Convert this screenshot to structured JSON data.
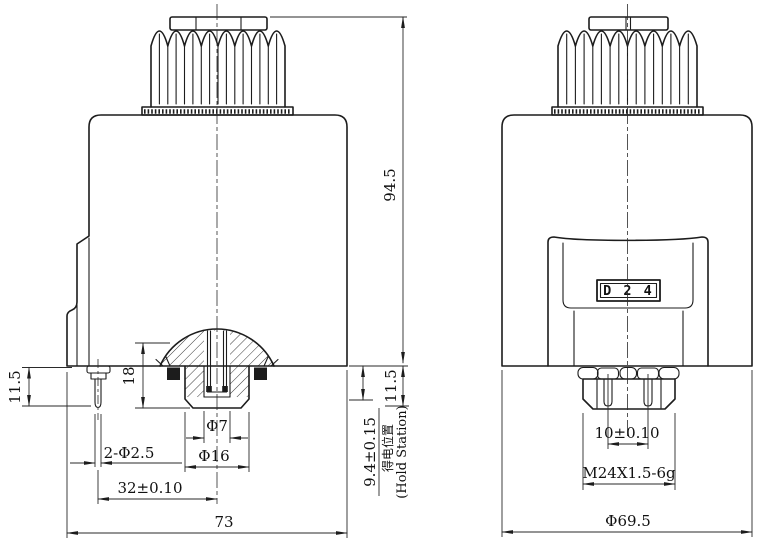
{
  "colors": {
    "background": "#ffffff",
    "line": "#1c1c1c"
  },
  "left_view": {
    "name": "side-section-view",
    "dimensions": {
      "total_height": "94.5",
      "pin_length": "11.5",
      "bore_depth": "18",
      "bore_diameter": "Φ7",
      "fitting_diameter": "Φ16",
      "terminal_pins": "2-Φ2.5",
      "pin_to_center": "32±0.10",
      "body_width": "73",
      "hold_position": "9.4±0.15",
      "hold_position_cn": "得电位置",
      "hold_position_en": "(Hold Station)",
      "release_position": "11.5"
    }
  },
  "right_view": {
    "name": "front-view",
    "model_label": "D 2 4",
    "dimensions": {
      "pin_spacing": "10±0.10",
      "mounting_thread": "M24X1.5-6g",
      "body_diameter": "Φ69.5"
    }
  }
}
